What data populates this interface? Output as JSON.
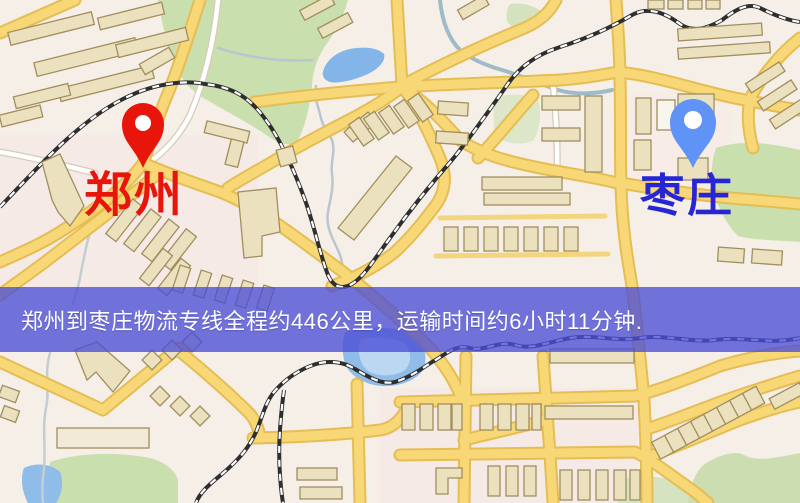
{
  "map": {
    "title": "郑州到枣庄物流线路图",
    "origin": {
      "label": "郑州",
      "marker_color": "#e8150b",
      "label_color": "#e8150b",
      "marker_icon": "red-location-pin"
    },
    "destination": {
      "label": "枣庄",
      "marker_color": "#5f93f5",
      "label_color": "#2626d4",
      "marker_icon": "blue-location-pin"
    },
    "banner": {
      "text": "郑州到枣庄物流专线全程约446公里，运输时间约6小时11分钟.",
      "bg_color": "#4c4dd6",
      "text_color": "#ffffff"
    },
    "route": {
      "distance": "约446公里",
      "duration": "约6小时11分钟"
    },
    "colors": {
      "background": "#f6efe7",
      "road_major": "#f8d876",
      "road_casing": "#e5bd55",
      "road_minor": "#ffffff",
      "park": "#c9dfae",
      "water": "#84b5e9",
      "railway": "#2e2e2e",
      "building_fill": "#ece1bf",
      "building_stroke": "#a08e5e"
    }
  }
}
